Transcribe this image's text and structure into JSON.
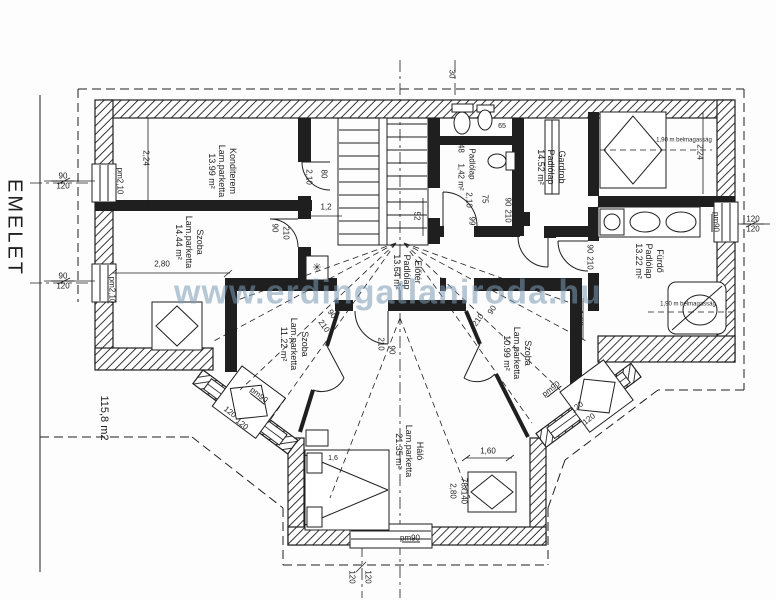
{
  "plan": {
    "title": "EMELET",
    "watermark": "www.erdingatlaniroda.hu",
    "total_area": "115,8 m2",
    "headroom_note": "1,90 m belmagasság",
    "ink_color": "#1f1f1f",
    "watermark_color": "#7a99b4"
  },
  "rooms": [
    {
      "name": "Konditerem",
      "material": "Lam.parketta",
      "area": "13.99 m²"
    },
    {
      "name": "Szoba",
      "material": "Lam.parketta",
      "area": "14.44 m²"
    },
    {
      "name": "Szoba",
      "material": "Lam.parketta",
      "area": "11.22 m²"
    },
    {
      "name": "Előtér",
      "material": "Padlólap",
      "area": "13.64 m²"
    },
    {
      "name": "Wc",
      "material": "Padlólap",
      "area_upper": "1,48",
      "area": "1,42 m²"
    },
    {
      "name": "Gardrob",
      "material": "Padlólap",
      "area": "14.52 m²"
    },
    {
      "name": "Fürdő",
      "material": "Padlólap",
      "area": "13.22 m²"
    },
    {
      "name": "Szoba",
      "material": "Lam.parketta",
      "area": "10.99 m²"
    },
    {
      "name": "Háló",
      "material": "Lam.parketta",
      "area": "21.35 m²"
    }
  ],
  "dims": {
    "left_top_over": "90",
    "left_top_under": "120",
    "left_bot_over": "90",
    "left_bot_under": "120",
    "right_over": "120",
    "right_under": "120",
    "bottom_a": "120",
    "bottom_b": "120",
    "bay_a": "120",
    "bay_b": "120",
    "bay_c": "120",
    "bay_d": "120",
    "d224": "2,24",
    "d224b": "2,24",
    "d280": "2,80",
    "d12": "1,2",
    "d52": "52",
    "d30": "30",
    "d65": "65",
    "d160": "1,60",
    "d160b": "1,60",
    "d16": "1,6",
    "crib": "78x140",
    "crib_w": "2,80",
    "pm210": "pm2,10",
    "pm210b": "pm2,10",
    "pm90": "pm90",
    "door90": "90",
    "door210": "210",
    "door80": "80",
    "door_h": "2,10",
    "door99": "99",
    "door75": "75"
  },
  "icons": {
    "flue": "✳"
  }
}
